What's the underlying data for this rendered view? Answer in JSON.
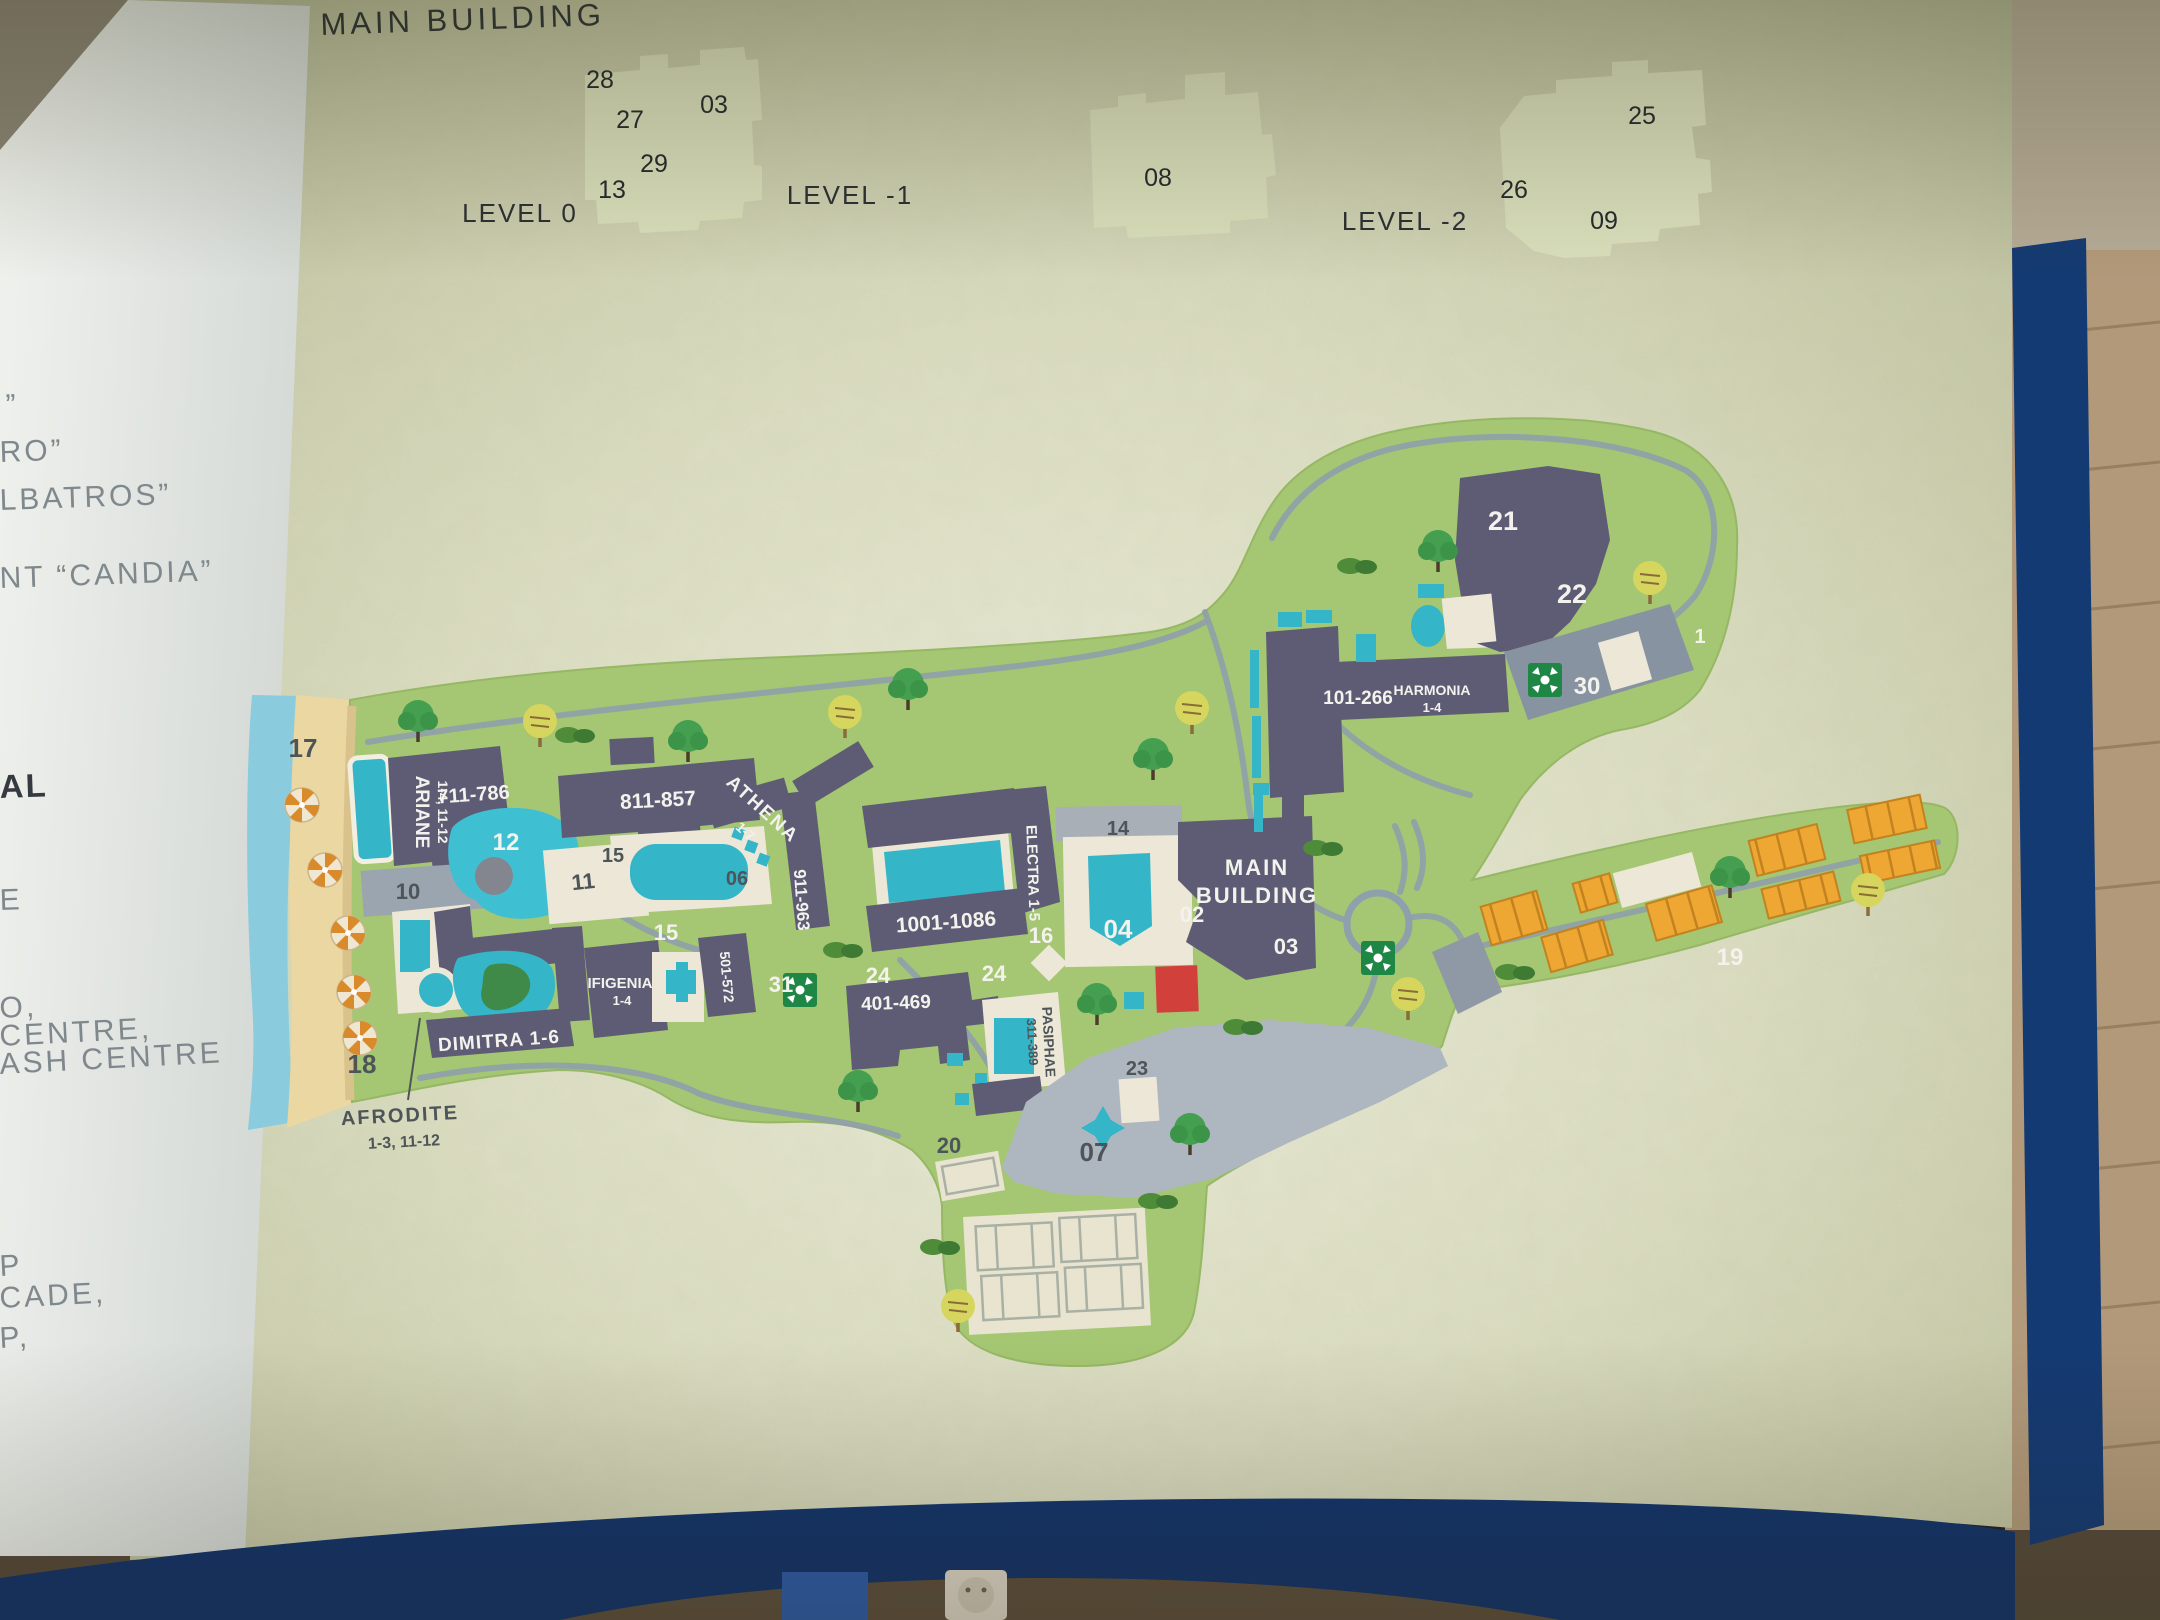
{
  "photo": {
    "subject": "resort site map information board",
    "frame_color": "#12336b",
    "wall": "brick"
  },
  "header": {
    "title": "MAIN BUILDING",
    "levels": [
      {
        "label": "LEVEL 0",
        "rooms": [
          "28",
          "27",
          "03",
          "29",
          "13"
        ]
      },
      {
        "label": "LEVEL -1",
        "rooms": [
          "08"
        ]
      },
      {
        "label": "LEVEL -2",
        "rooms": [
          "25",
          "26",
          "09"
        ]
      }
    ]
  },
  "legend": {
    "fragments": [
      "”",
      "RO”",
      "LBATROS”",
      "NT “CANDIA”",
      "AL",
      "E",
      "O,",
      "CENTRE,",
      "ASH CENTRE",
      "P",
      "CADE,",
      "P,"
    ]
  },
  "map": {
    "buildings": {
      "ariane": "ARIANE",
      "ariane_units": "1-4, 11-12",
      "ariane_rooms": "711-786",
      "block811": "811-857",
      "athena": "ATHENA",
      "athena_units": "1-7",
      "block911": "911-963",
      "block1001": "1001-1086",
      "electra": "ELECTRA 1-5",
      "block501": "501-572",
      "ifigenia": "IFIGENIA",
      "ifigenia_units": "1-4",
      "dimitra": "DIMITRA 1-6",
      "afrodite": "AFRODITE",
      "afrodite_units": "1-3, 11-12",
      "block401": "401-469",
      "pasiphae": "PASIPHAE",
      "pasiphae_rooms": "311-389",
      "harmonia_rooms": "101-266",
      "harmonia": "HARMONIA",
      "harmonia_units": "1-4",
      "main1": "MAIN",
      "main2": "BUILDING"
    },
    "markers": {
      "n1": "1",
      "n02": "02",
      "n03": "03",
      "n04": "04",
      "n06": "06",
      "n07": "07",
      "n10": "10",
      "n11": "11",
      "n12": "12",
      "n14": "14",
      "n15a": "15",
      "n15b": "15",
      "n16": "16",
      "n17": "17",
      "n18": "18",
      "n19": "19",
      "n20": "20",
      "n21": "21",
      "n22": "22",
      "n23": "23",
      "n24a": "24",
      "n24b": "24",
      "n30": "30",
      "n31": "31"
    },
    "icons": {
      "meeting_point": "green-square-crossed-arrows",
      "umbrella": "beach-umbrella",
      "tree": "tree",
      "tennis": "tennis-court"
    }
  },
  "colors": {
    "sign": "#d7dabd",
    "map_green": "#a5c672",
    "building_dark": "#5e5c74",
    "building_light": "#8e99a5",
    "pool": "#35b5c8",
    "sea": "#8accdd",
    "sand": "#ead7a1",
    "red_unit": "#d2403b",
    "bungalow": "#efa733",
    "plaza": "#aeb7c0",
    "frame": "#12336b"
  }
}
